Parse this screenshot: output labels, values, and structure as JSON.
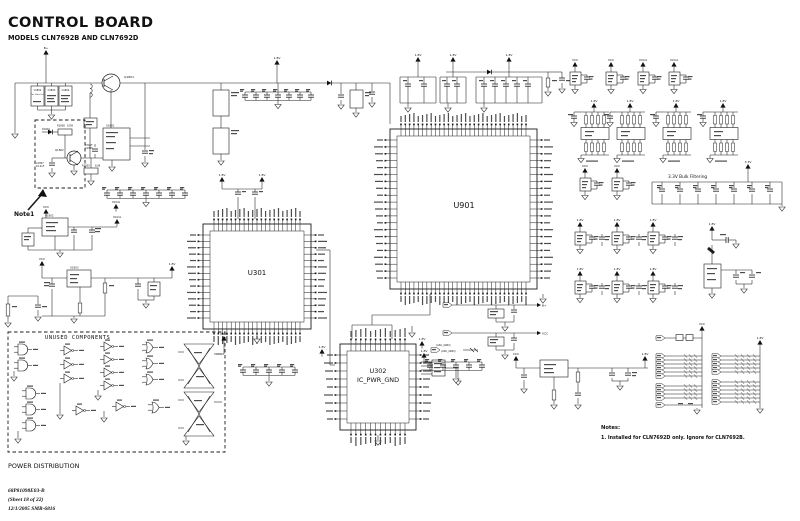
{
  "header": {
    "title": "CONTROL BOARD",
    "subtitle": "MODELS CLN7692B AND CLN7692D"
  },
  "ics": {
    "u901": {
      "label": "U901"
    },
    "u301": {
      "label": "U301"
    },
    "u302": {
      "label": "U302",
      "sublabel": "IC_PWR_GND"
    }
  },
  "sections": {
    "unused_components": "UNUSED COMPONENTS",
    "bulk_filtering": "3.3V Bulk Filtering",
    "note1": "Note1",
    "power_distribution": "POWER DISTRIBUTION"
  },
  "notes": {
    "title": "Notes:",
    "line1": "1. Installed for CLN7692D only. Ignore for CLN7692B."
  },
  "footer": {
    "part_number": "68P81098E03-B",
    "sheet": "(Sheet 18 of 22)",
    "date_smr": "12/1/2005    SMR-6816"
  },
  "labels": {
    "bplus": "B+",
    "v18": "1.8V",
    "v33": "3.3V",
    "vcc": "VCC",
    "vcca": "VCCA",
    "c1802": "C1802",
    "c1803": "C1803",
    "c1804": "C1804",
    "see_parts": "See Parts List",
    "q1801": "Q1801",
    "q1802": "Q1802",
    "d1801": "D1801",
    "r1808": "R1808",
    "r1808_val": "100K",
    "c1807": "C1807",
    "c1807_val": "10.0uF",
    "c1805": "C1805",
    "c1805_val": "470pF",
    "r1802": "R1802",
    "r1802_val": "6.8K",
    "u1801": "U1801",
    "u1802": "U1802",
    "u1803": "U1803",
    "asc_gnd": "(ASC_GND)"
  }
}
